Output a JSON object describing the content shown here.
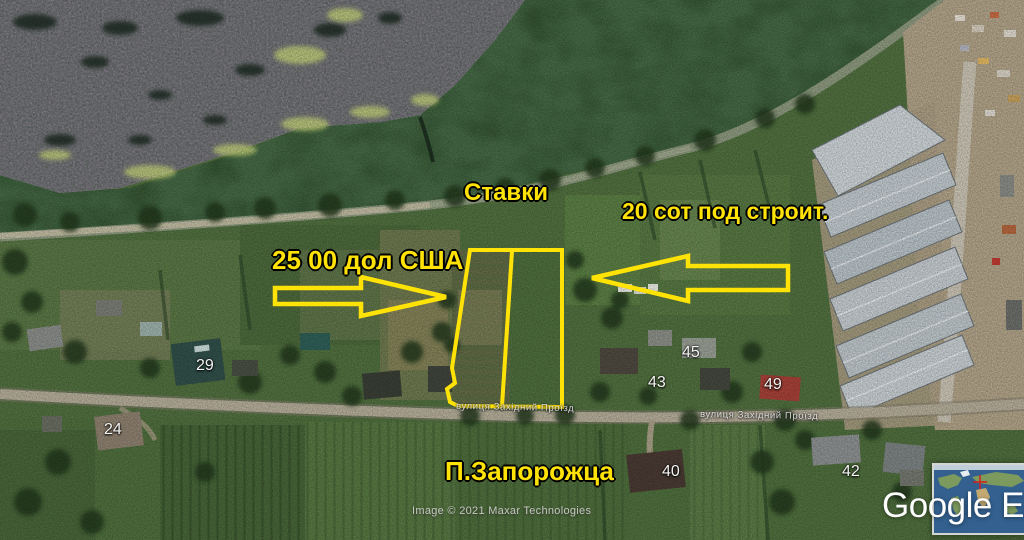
{
  "overlay": {
    "labels": {
      "ponds": "Ставки",
      "area": "20 сот под строит.",
      "price": "25 00 дол США",
      "settlement": "П.Запорожца"
    },
    "house_numbers": [
      "29",
      "24",
      "45",
      "43",
      "49",
      "40",
      "42"
    ],
    "street_labels": [
      "вулиця Західний Проїзд",
      "вулиця Західний Проїзд"
    ],
    "annotation_color": "#ffe206"
  },
  "attribution": {
    "imagery_credit": "Image © 2021 Maxar Technologies",
    "logo": "Google Ea"
  }
}
